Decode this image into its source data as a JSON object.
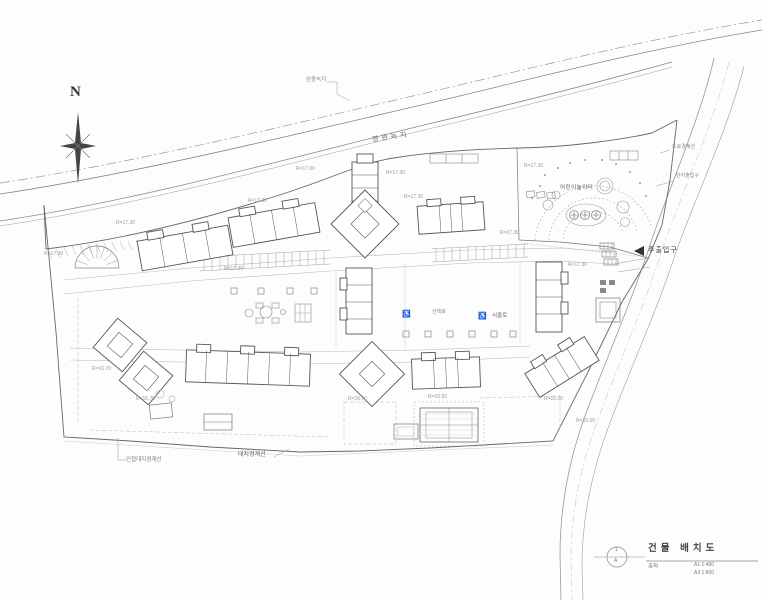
{
  "labels": {
    "north": "N",
    "landscape_green": "경관녹지",
    "buffer_green": "완충녹지",
    "playground": "어린이놀이터",
    "main_entrance": "주출입구",
    "road_boundary": "도로경계선",
    "site_entrance": "단지출입구",
    "site_boundary": "대지경계선",
    "adjacent_site_boundary": "인접대지경계선",
    "walkway": "산책로",
    "circle_path": "서클로",
    "wheelchair_symbol": "♿"
  },
  "title_block": {
    "sheet_no": "1",
    "sheet_row": "A",
    "title": "건물 배치도",
    "scale_label": "축척",
    "scale_a1": "A1 1:400",
    "scale_a3": "A3 1:800"
  },
  "annotations": [
    {
      "text": "R=17.00",
      "x": 44,
      "y": 251
    },
    {
      "text": "R=17.30",
      "x": 116,
      "y": 220
    },
    {
      "text": "R=17.30",
      "x": 248,
      "y": 198
    },
    {
      "text": "R=17.00",
      "x": 296,
      "y": 166
    },
    {
      "text": "R=17.30",
      "x": 386,
      "y": 170
    },
    {
      "text": "R=17.30",
      "x": 404,
      "y": 194
    },
    {
      "text": "R=17.30",
      "x": 524,
      "y": 163
    },
    {
      "text": "R=17.30",
      "x": 500,
      "y": 230
    },
    {
      "text": "R=17.30",
      "x": 224,
      "y": 266
    },
    {
      "text": "R=17.30",
      "x": 568,
      "y": 262
    },
    {
      "text": "R=16.70",
      "x": 92,
      "y": 366
    },
    {
      "text": "R=16.70",
      "x": 136,
      "y": 396
    },
    {
      "text": "R=16.70",
      "x": 348,
      "y": 396
    },
    {
      "text": "R=16.50",
      "x": 428,
      "y": 394
    },
    {
      "text": "R=16.00",
      "x": 544,
      "y": 396
    },
    {
      "text": "R=16.00",
      "x": 576,
      "y": 418
    }
  ]
}
